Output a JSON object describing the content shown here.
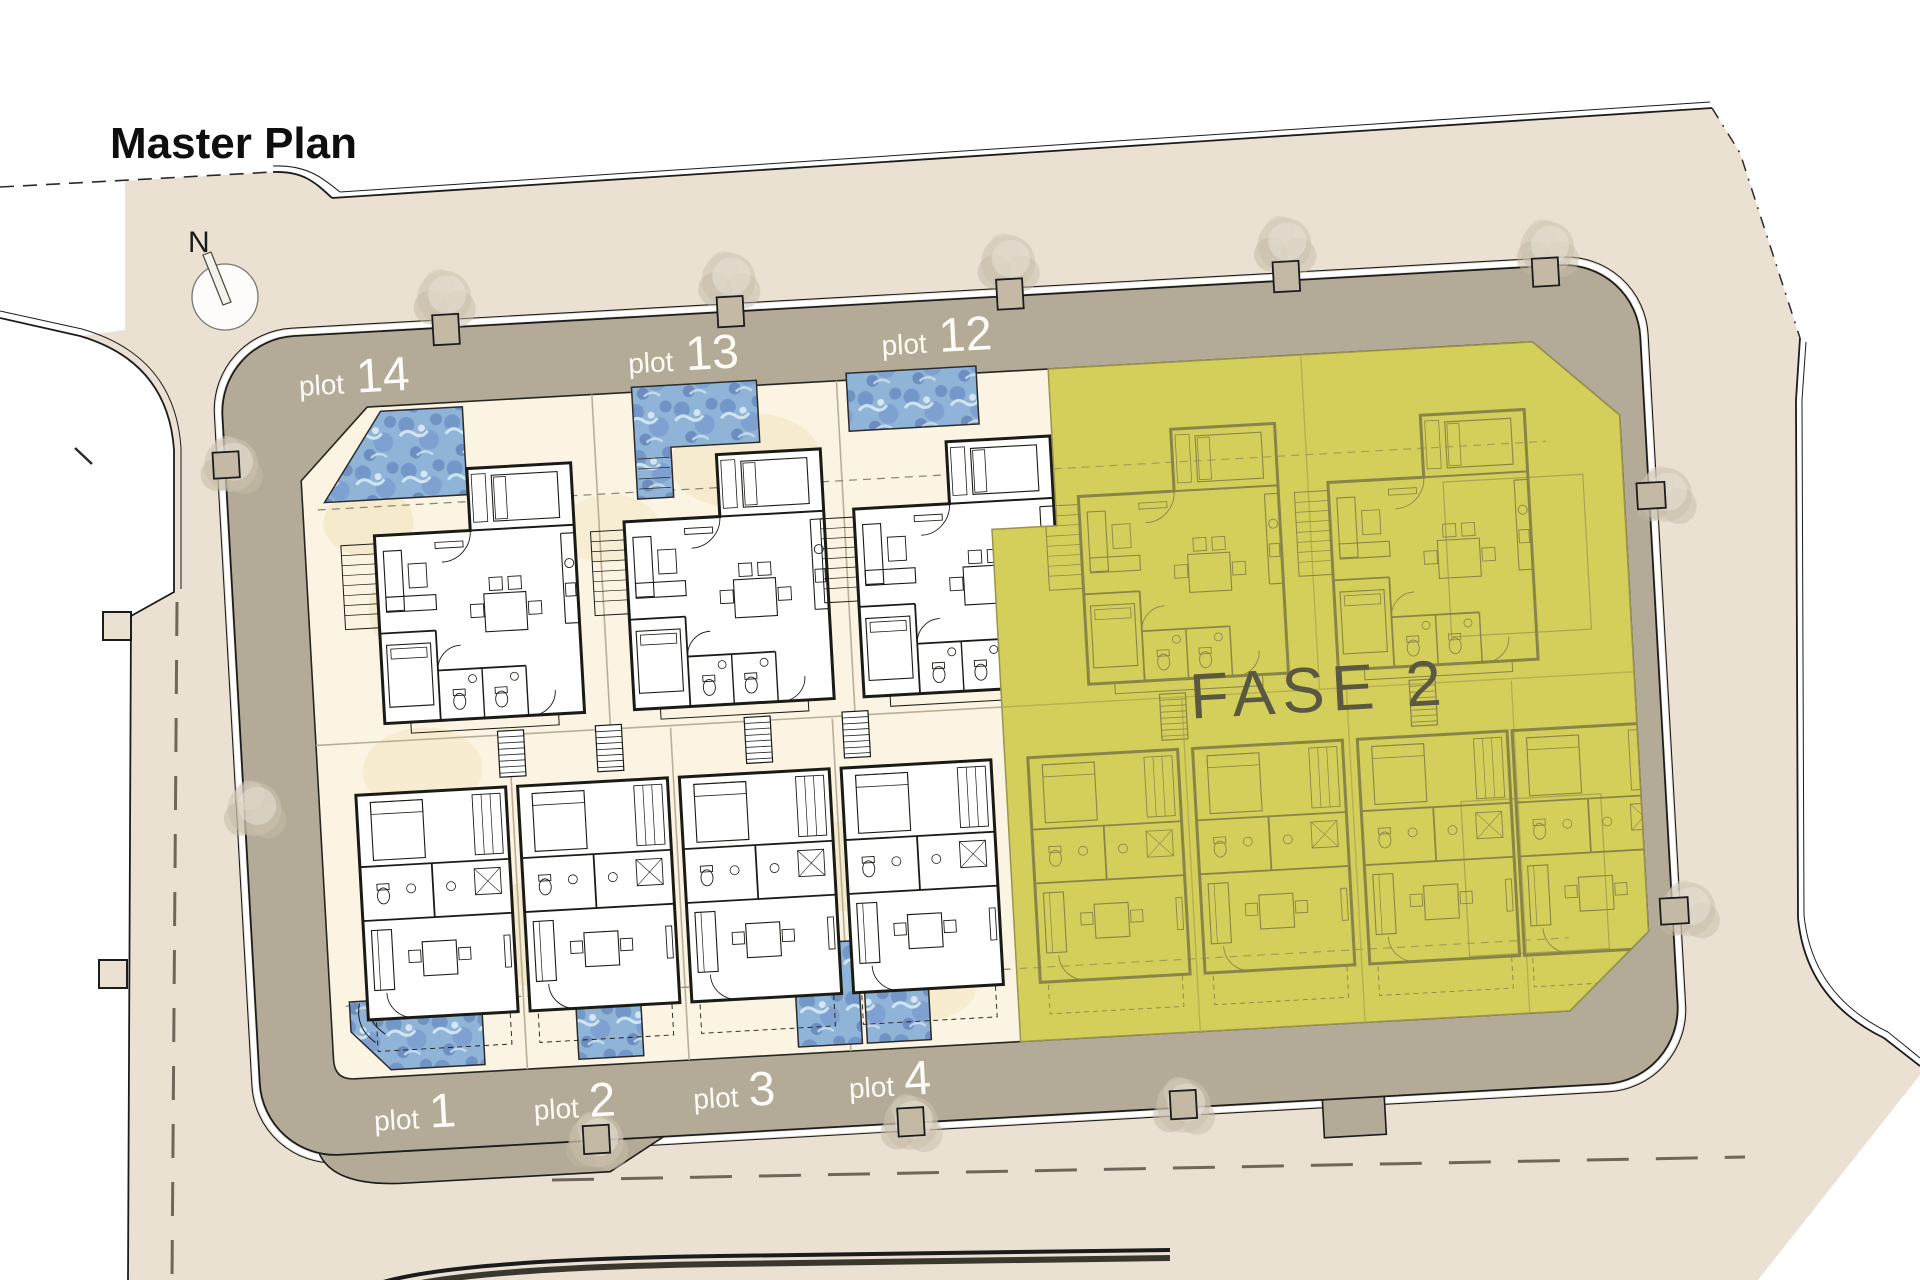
{
  "title": "Master Plan",
  "compass": {
    "label": "N"
  },
  "phase2": {
    "label": "FASE 2"
  },
  "plots_top": [
    {
      "prefix": "plot",
      "number": "14"
    },
    {
      "prefix": "plot",
      "number": "13"
    },
    {
      "prefix": "plot",
      "number": "12"
    }
  ],
  "plots_bottom": [
    {
      "prefix": "plot",
      "number": "1"
    },
    {
      "prefix": "plot",
      "number": "2"
    },
    {
      "prefix": "plot",
      "number": "3"
    },
    {
      "prefix": "plot",
      "number": "4"
    }
  ],
  "colors": {
    "context_beige": "#ebe1d3",
    "road_band": "#b3aa97",
    "inner_cream": "#fbf4e2",
    "phase2_fill": "#d4ce5b",
    "phase2_lines": "#8a8547",
    "phase2_text": "#5b5842",
    "pool_blue": "#8fb4d8",
    "plan_lines": "#1b1b16",
    "label_text": "#fdfcf6"
  }
}
